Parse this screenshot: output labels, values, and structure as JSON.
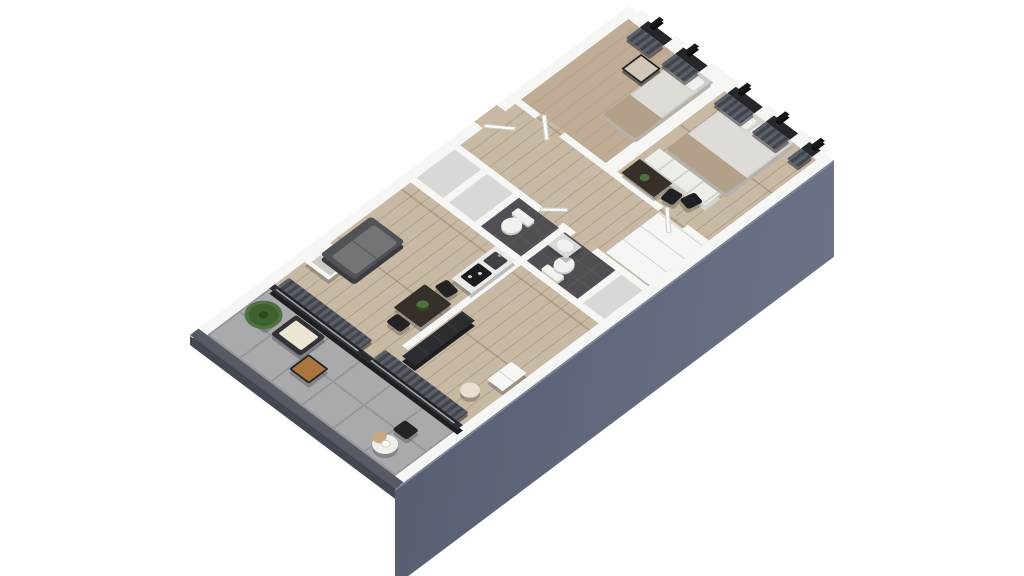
{
  "scene": {
    "kind": "isometric-3d-floor-plan-render",
    "description": "Bird's-eye isometric render of a two-bedroom apartment with a tiled balcony, open living/dining/kitchen, central bathroom and closet core, corridor, and two bedrooms with a window band; tall slate facade on the lower-right side.",
    "background": "#ffffff"
  },
  "palette": {
    "bg": "#ffffff",
    "wall": "#f6f6f4",
    "wallface": "#dddddab",
    "facade": "#575e70",
    "facadeLight": "#6b7285",
    "facadeEdge": "#7d8396",
    "parapet": "#565a65",
    "parapetface": "#434752",
    "tile": "#a9aaab",
    "grout": "#95969a",
    "wood": "#c7b9a4",
    "woodline": "rgba(130,110,85,0.38)",
    "carpet": "#bfac94",
    "bathfloor": "#504e52",
    "cellfloor": "#d8d8d4",
    "dark": "#2b2d31",
    "curtainA": "#5a5e66",
    "curtainB": "#42454d",
    "sofa": "#505256",
    "sofaseat": "#727477",
    "espresso": "#362f2a",
    "cream": "#ece5d3",
    "tan": "#b2a089",
    "duvet": "#dfdbd6",
    "pillow": "#efefed",
    "counter": "#eaeae8",
    "cooktop": "#1b1c1e",
    "sinkmetal": "#3f4145",
    "green": "#4e7340",
    "greendark": "#31491f",
    "woodtop": "#aa743e",
    "fixture": "#f1f1ef",
    "pampas": "#c8a77e"
  },
  "rooms": [
    {
      "name": "balcony",
      "floor": "gray-tile"
    },
    {
      "name": "living-dining-kitchen",
      "floor": "light-oak"
    },
    {
      "name": "study-room",
      "floor": "light-oak"
    },
    {
      "name": "bathroom-1",
      "floor": "dark-tile"
    },
    {
      "name": "bathroom-2",
      "floor": "dark-tile"
    },
    {
      "name": "storage-cells",
      "floor": "gray"
    },
    {
      "name": "corridor",
      "floor": "light-oak"
    },
    {
      "name": "bedroom-1",
      "floor": "tan-carpet"
    },
    {
      "name": "bedroom-2",
      "floor": "light-oak"
    }
  ],
  "furniture": [
    {
      "name": "potted-tree",
      "room": "balcony"
    },
    {
      "name": "armchair",
      "room": "balcony"
    },
    {
      "name": "side-table",
      "room": "balcony"
    },
    {
      "name": "round-table-with-pampas",
      "room": "balcony"
    },
    {
      "name": "balcony-chair",
      "room": "balcony"
    },
    {
      "name": "sliding-glass-doors-with-curtains",
      "room": "balcony"
    },
    {
      "name": "shelf-unit",
      "room": "living-dining-kitchen"
    },
    {
      "name": "sofa",
      "room": "living-dining-kitchen"
    },
    {
      "name": "dining-table-with-plant",
      "room": "living-dining-kitchen"
    },
    {
      "name": "dining-chairs",
      "room": "living-dining-kitchen"
    },
    {
      "name": "kitchen-counter-cooktop-sink",
      "room": "living-dining-kitchen"
    },
    {
      "name": "wardrobe",
      "room": "study-room"
    },
    {
      "name": "pouf",
      "room": "study-room"
    },
    {
      "name": "low-cabinet",
      "room": "study-room"
    },
    {
      "name": "toilet",
      "room": "bathroom-1"
    },
    {
      "name": "toilet",
      "room": "bathroom-2"
    },
    {
      "name": "wash-basin",
      "room": "bathroom-2"
    },
    {
      "name": "closet-row",
      "room": "corridor"
    },
    {
      "name": "single-bed",
      "room": "bedroom-1"
    },
    {
      "name": "cube-nightstand",
      "room": "bedroom-1"
    },
    {
      "name": "double-bed",
      "room": "bedroom-2"
    },
    {
      "name": "shelving-dresser",
      "room": "bedroom-2"
    },
    {
      "name": "desk-with-plant",
      "room": "bedroom-2"
    },
    {
      "name": "desk-chairs",
      "room": "bedroom-2"
    },
    {
      "name": "window-band-with-curtains",
      "room": "bedrooms"
    }
  ]
}
